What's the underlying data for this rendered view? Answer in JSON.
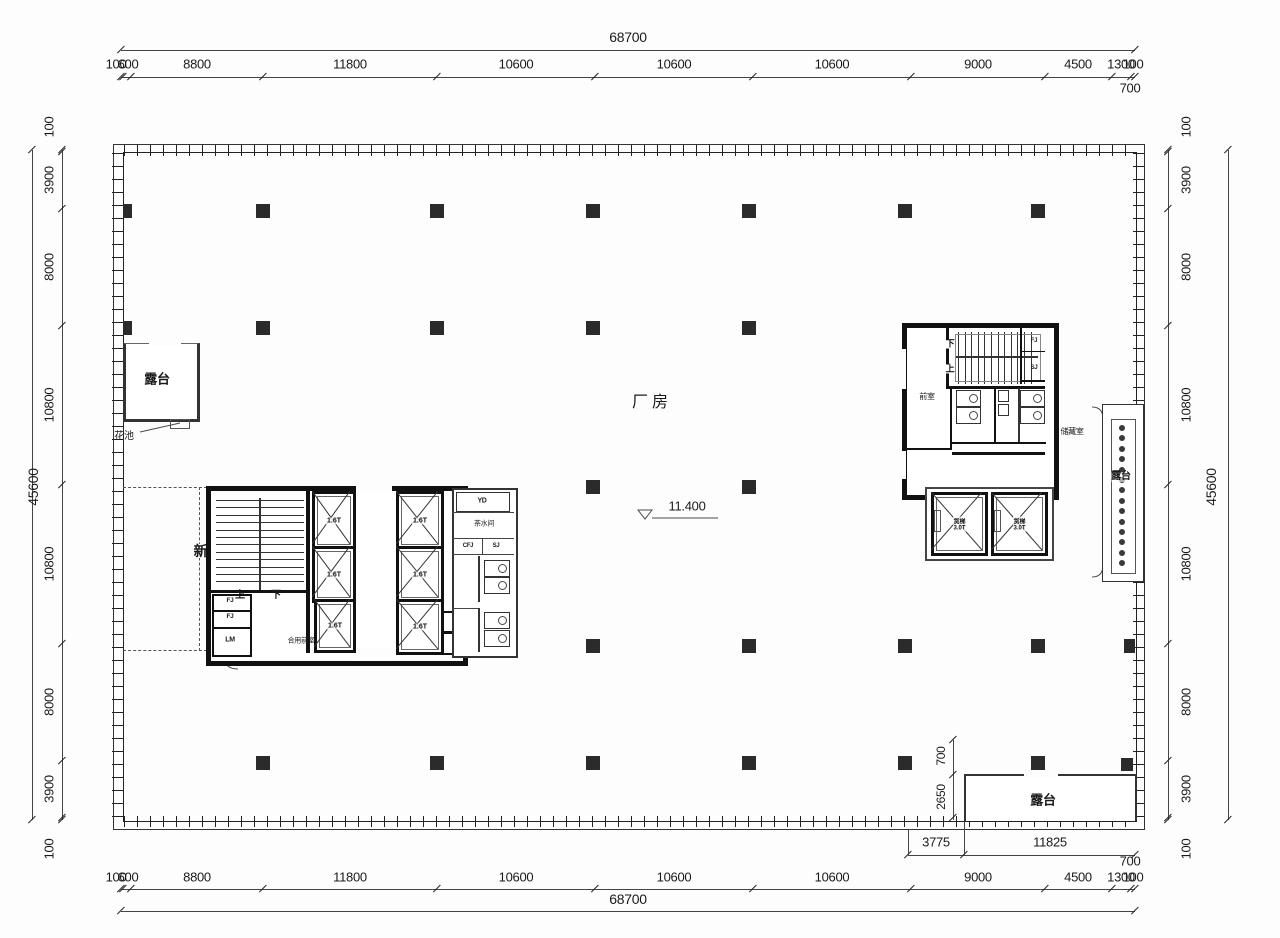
{
  "drawing": {
    "hall_label": "厂房",
    "elevation": "11.400",
    "fresh_air_room": "新风机房",
    "terrace_top_left": "露台",
    "terrace_right": "露台",
    "terrace_bottom": "露台",
    "flower_bed": "花池",
    "storage_room": "储藏室",
    "vestibule": "前室",
    "shared_vestibule": "合用前室",
    "tea_room": "茶水间",
    "up": "上",
    "down": "下",
    "rooms": {
      "yd": "YD",
      "cfj": "CFJ",
      "sj": "SJ",
      "qd": "QD",
      "rd": "RD",
      "fj": "FJ",
      "lm": "LM"
    },
    "elevators": {
      "passenger_capacity": "1.6T",
      "freight_name": "货梯",
      "freight_capacity": "3.0T"
    }
  },
  "dims": {
    "top": {
      "total": "68700",
      "segments": [
        "100",
        "600",
        "8800",
        "11800",
        "10600",
        "10600",
        "10600",
        "9000",
        "4500",
        "1300",
        "100"
      ],
      "extra": "700"
    },
    "bottom": {
      "total": "68700",
      "segments": [
        "100",
        "600",
        "8800",
        "11800",
        "10600",
        "10600",
        "10600",
        "9000",
        "4500",
        "1300",
        "100"
      ],
      "extra": "700",
      "terrace_a": "3775",
      "terrace_b": "11825"
    },
    "left": {
      "total": "45600",
      "segments": [
        "100",
        "3900",
        "8000",
        "10800",
        "10800",
        "8000",
        "3900",
        "100"
      ]
    },
    "right": {
      "total": "45600",
      "segments": [
        "100",
        "3900",
        "8000",
        "10800",
        "10800",
        "8000",
        "3900",
        "100"
      ]
    },
    "terrace_vertical": {
      "a": "700",
      "b": "2650"
    }
  }
}
